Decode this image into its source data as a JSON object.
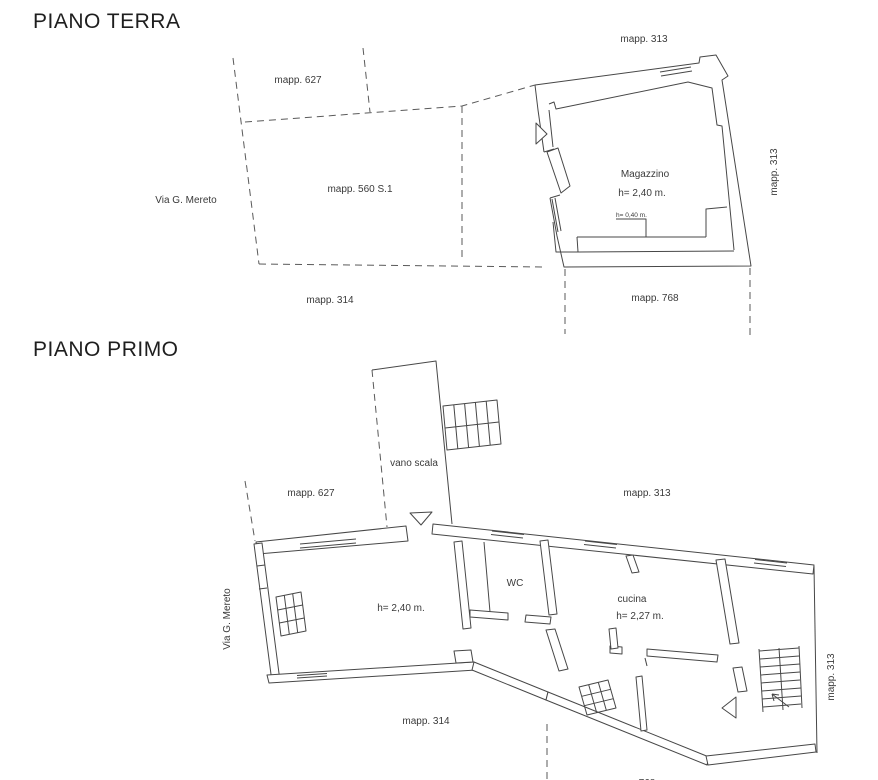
{
  "canvas": {
    "width": 878,
    "height": 780,
    "background": "#ffffff",
    "ink_color": "#474747",
    "dash_color": "#5a5a5a",
    "text_color": "#3a3a3a"
  },
  "piano_terra": {
    "title": "PIANO TERRA",
    "labels": {
      "mapp_313_top": "mapp. 313",
      "mapp_627": "mapp. 627",
      "via_mereto": "Via G. Mereto",
      "mapp_560": "mapp. 560 S.1",
      "mapp_313_right": "mapp. 313",
      "magazzino": "Magazzino",
      "magazzino_height": "h= 2,40 m.",
      "parapet_height": "h= 0,40 m.",
      "mapp_314": "mapp. 314",
      "mapp_768": "mapp. 768"
    }
  },
  "piano_primo": {
    "title": "PIANO PRIMO",
    "labels": {
      "vano_scala": "vano scala",
      "mapp_627": "mapp. 627",
      "mapp_313_top": "mapp. 313",
      "via_mereto": "Via G. Mereto",
      "main_room_height": "h= 2,40 m.",
      "wc": "WC",
      "cucina": "cucina",
      "cucina_height": "h= 2,27 m.",
      "mapp_314": "mapp. 314",
      "mapp_313_right": "mapp. 313",
      "mapp_768_clipped": "768"
    }
  }
}
